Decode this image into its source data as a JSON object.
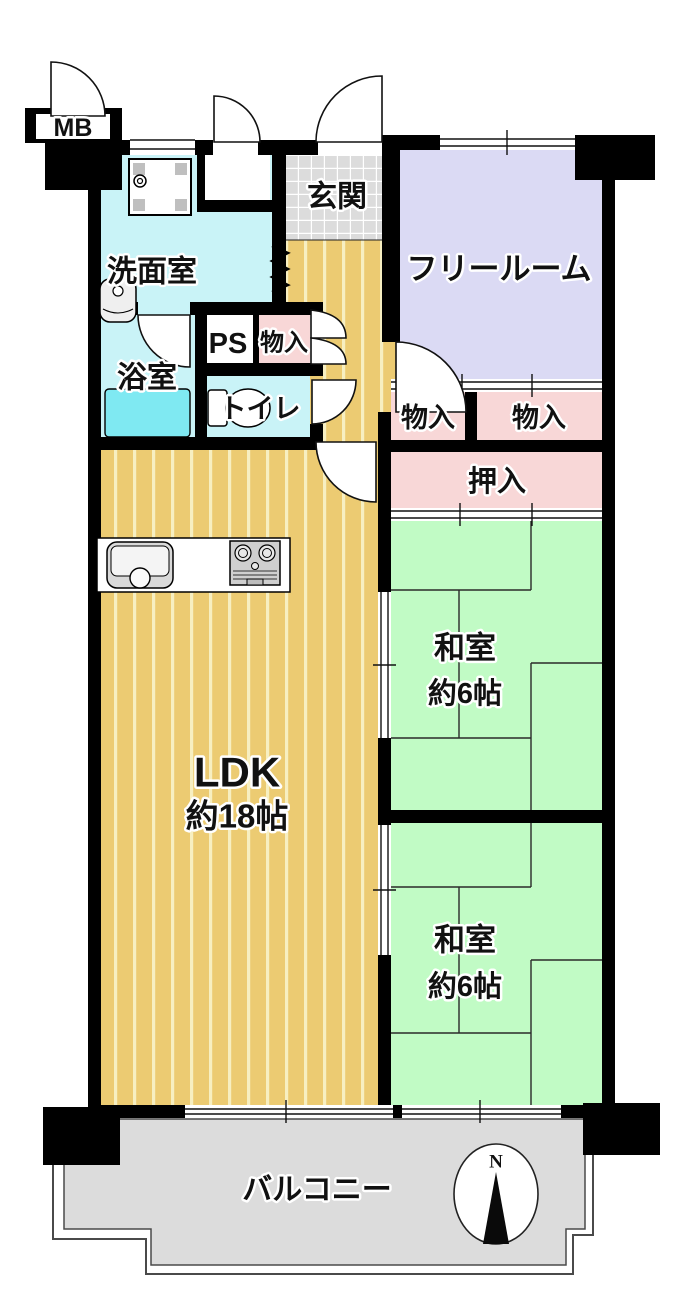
{
  "floorplan": {
    "labels": {
      "mb": "MB",
      "entrance": "玄関",
      "washroom": "洗面室",
      "free_room": "フリールーム",
      "pipe_space": "PS",
      "storage_by_ps": "物入",
      "bathroom": "浴室",
      "toilet": "トイレ",
      "storage_left": "物入",
      "storage_right": "物入",
      "oshiire": "押入",
      "japanese_room_1": {
        "name": "和室",
        "size": "約6帖"
      },
      "japanese_room_2": {
        "name": "和室",
        "size": "約6帖"
      },
      "ldk": {
        "name": "LDK",
        "size": "約18帖"
      },
      "balcony": "バルコニー",
      "compass_north": "N"
    },
    "colors": {
      "wall": "#000000",
      "water_rooms": "#C9F3F7",
      "bathtub": "#7FE9F2",
      "tile": "#DCDCDC",
      "tile_grid": "#FFFFFF",
      "free_room": "#DBDAF4",
      "storage_pink": "#F8D7D7",
      "tatami_green": "#C1FBC5",
      "flooring_base": "#ECCB72",
      "flooring_stripe": "#F7EFC1",
      "balcony": "#DCDCDC",
      "fixture_gray": "#D9D9D9",
      "white": "#FFFFFF"
    }
  }
}
